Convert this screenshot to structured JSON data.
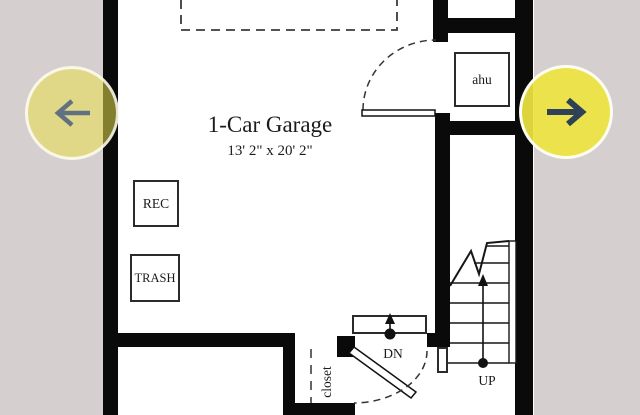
{
  "carousel": {
    "prev_button": {
      "icon": "arrow-left",
      "arrow_color": "#5f7183"
    },
    "next_button": {
      "icon": "arrow-right",
      "arrow_color": "#2e4157"
    },
    "button_color": "#e9df4a"
  },
  "floorplan": {
    "title": "1-Car Garage",
    "dimensions": "13' 2\" x 20' 2\"",
    "labels": {
      "rec": "REC",
      "trash": "TRASH",
      "ahu": "ahu",
      "down": "DN",
      "up": "UP",
      "closet": "closet"
    }
  },
  "colors": {
    "outer_background": "#d5cfcf",
    "plan_background": "#ffffff",
    "wall": "#0a0a0a"
  }
}
